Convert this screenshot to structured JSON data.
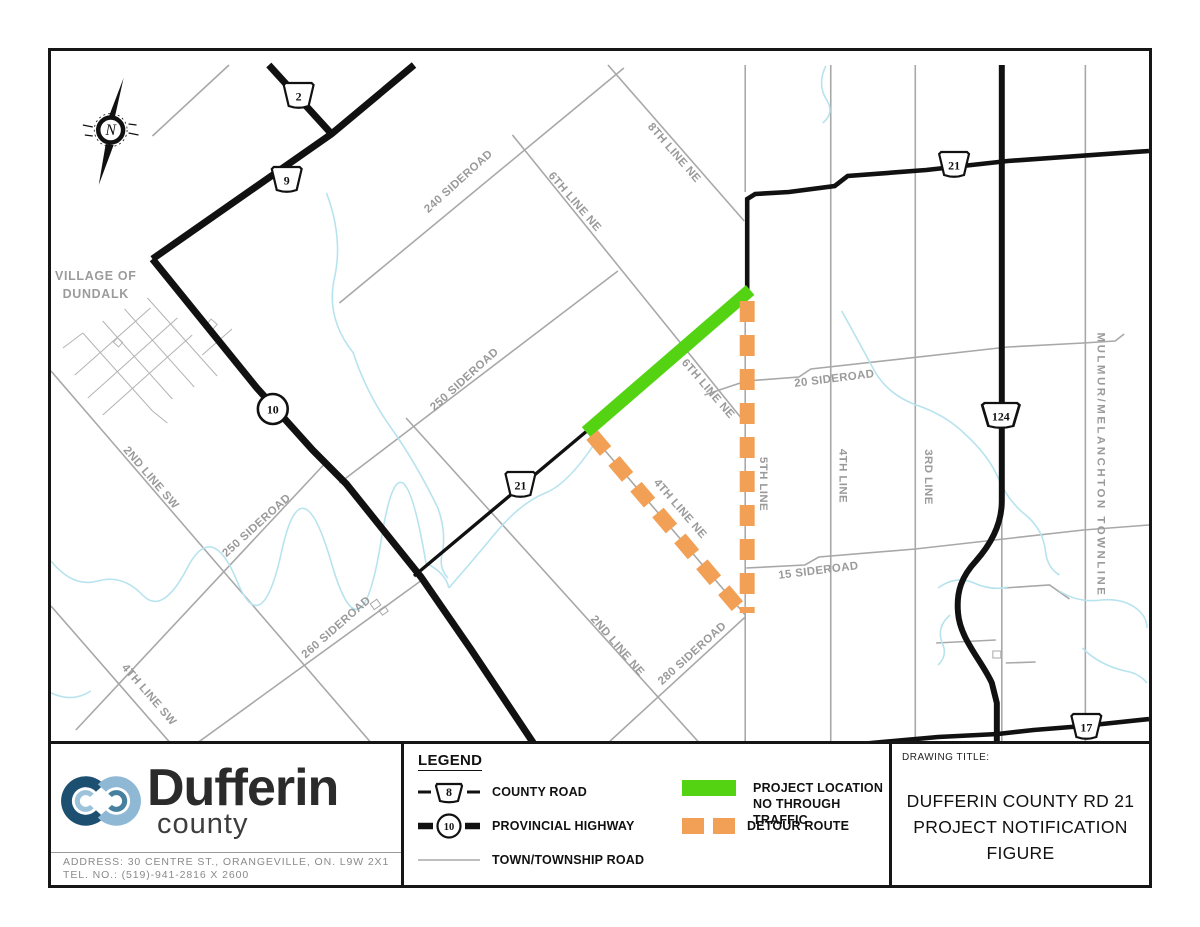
{
  "map": {
    "village": {
      "line1": "VILLAGE OF",
      "line2": "DUNDALK"
    },
    "road_labels": [
      {
        "text": "240 SIDEROAD",
        "x": 460,
        "y": 181,
        "rot": -42
      },
      {
        "text": "6TH LINE NE",
        "x": 572,
        "y": 201,
        "rot": 49
      },
      {
        "text": "8TH LINE NE",
        "x": 672,
        "y": 152,
        "rot": 49
      },
      {
        "text": "250 SIDEROAD",
        "x": 466,
        "y": 379,
        "rot": -42
      },
      {
        "text": "6TH LINE NE",
        "x": 706,
        "y": 388,
        "rot": 49
      },
      {
        "text": "4TH LINE NE",
        "x": 678,
        "y": 508,
        "rot": 49
      },
      {
        "text": "5TH LINE",
        "x": 761,
        "y": 481,
        "rot": 90
      },
      {
        "text": "4TH LINE",
        "x": 841,
        "y": 473,
        "rot": 90
      },
      {
        "text": "3RD LINE",
        "x": 927,
        "y": 474,
        "rot": 90
      },
      {
        "text": "MULMUR/MELANCHTON TOWNLINE",
        "x": 1100,
        "y": 462,
        "rot": 90,
        "ls": 2.5
      },
      {
        "text": "20 SIDEROAD",
        "x": 836,
        "y": 379,
        "rot": -7
      },
      {
        "text": "15 SIDEROAD",
        "x": 820,
        "y": 571,
        "rot": -7
      },
      {
        "text": "2ND LINE SW",
        "x": 146,
        "y": 477,
        "rot": 49
      },
      {
        "text": "250 SIDEROAD",
        "x": 257,
        "y": 525,
        "rot": -42
      },
      {
        "text": "260 SIDEROAD",
        "x": 337,
        "y": 627,
        "rot": -41
      },
      {
        "text": "4TH LINE SW",
        "x": 144,
        "y": 694,
        "rot": 49
      },
      {
        "text": "2ND LINE NE",
        "x": 615,
        "y": 645,
        "rot": 49
      },
      {
        "text": "280 SIDEROAD",
        "x": 695,
        "y": 653,
        "rot": -42
      }
    ],
    "shields": [
      {
        "num": "2",
        "shape": "trapezoid",
        "x": 297,
        "y": 93
      },
      {
        "num": "9",
        "shape": "trapezoid",
        "x": 285,
        "y": 177
      },
      {
        "num": "10",
        "shape": "circle",
        "x": 271,
        "y": 406
      },
      {
        "num": "21",
        "shape": "trapezoid",
        "x": 520,
        "y": 482
      },
      {
        "num": "21",
        "shape": "trapezoid",
        "x": 956,
        "y": 162
      },
      {
        "num": "124",
        "shape": "trapezoid",
        "x": 1003,
        "y": 413
      },
      {
        "num": "17",
        "shape": "trapezoid",
        "x": 1089,
        "y": 724
      }
    ],
    "colors": {
      "project": "#54d313",
      "detour": "#f2a055",
      "town_road": "#a8a8a8",
      "highway": "#111111",
      "stream": "#b7e3ee",
      "label": "#9a9a9a"
    }
  },
  "legend": {
    "title": "LEGEND",
    "county_label": "COUNTY ROAD",
    "county_num": "8",
    "provincial_label": "PROVINCIAL HIGHWAY",
    "provincial_num": "10",
    "township_label": "TOWN/TOWNSHIP ROAD",
    "project_line1": "PROJECT LOCATION",
    "project_line2": "NO THROUGH TRAFFIC",
    "detour_label": "DETOUR ROUTE"
  },
  "logo": {
    "name": "Dufferin",
    "subtitle": "county",
    "address": "ADDRESS: 30 CENTRE ST., ORANGEVILLE, ON. L9W 2X1",
    "phone": "TEL. NO.: (519)-941-2816 X 2600"
  },
  "title_block": {
    "label": "DRAWING TITLE:",
    "line1": "DUFFERIN COUNTY RD 21",
    "line2": "PROJECT NOTIFICATION FIGURE"
  }
}
